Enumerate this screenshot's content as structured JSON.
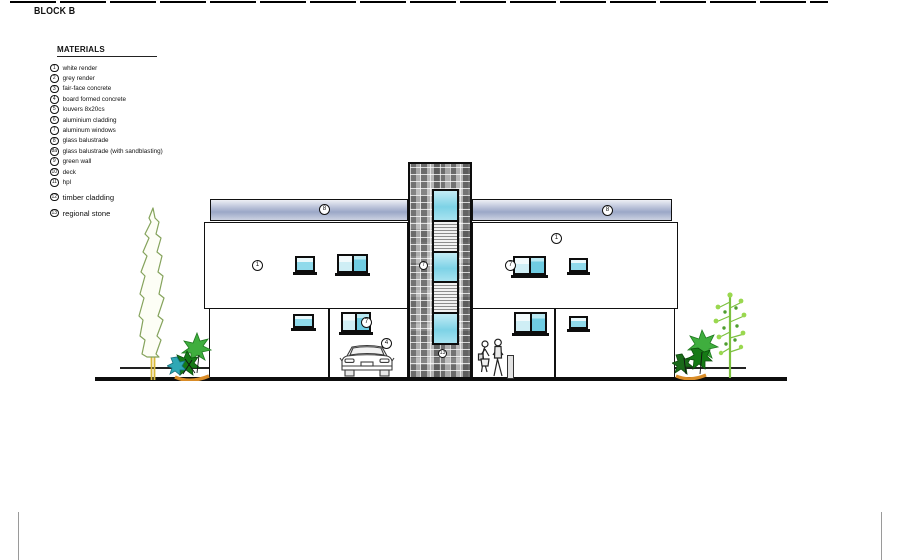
{
  "page": {
    "title": "BLOCK B"
  },
  "legend": {
    "title": "MATERIALS",
    "items": [
      {
        "num": "1",
        "label": "white render"
      },
      {
        "num": "2",
        "label": "grey render"
      },
      {
        "num": "3",
        "label": "fair-face concrete"
      },
      {
        "num": "4",
        "label": "board formed concrete"
      },
      {
        "num": "5",
        "label": "louvers 8x20cs"
      },
      {
        "num": "6",
        "label": "aluminium cladding"
      },
      {
        "num": "7",
        "label": "aluminum windows"
      },
      {
        "num": "8",
        "label": "glass balustrade"
      },
      {
        "num": "8a",
        "label": "glass balustrade (with sandblasting)"
      },
      {
        "num": "9",
        "label": "green wall"
      },
      {
        "num": "10",
        "label": "deck"
      },
      {
        "num": "11",
        "label": "hpl"
      },
      {
        "num": "12",
        "label": "timber cladding"
      },
      {
        "num": "13",
        "label": "regional stone"
      }
    ]
  },
  "elevation": {
    "annotations": {
      "band_left": "8",
      "band_right": "8",
      "upper_wall_left": "1",
      "upper_wall_right": "1",
      "window_upper_right": "7",
      "window_lower_left": "7",
      "tower_window": "7",
      "tower_base": "13",
      "car": "4"
    },
    "colors": {
      "glass": "#8fd9ea",
      "balustrade_band": "#9ba7c7",
      "stone_grey": "#979797",
      "tree_green": "#3fae3e",
      "trunk_yellow": "#d9b93a",
      "base_orange": "#d98c28"
    }
  }
}
